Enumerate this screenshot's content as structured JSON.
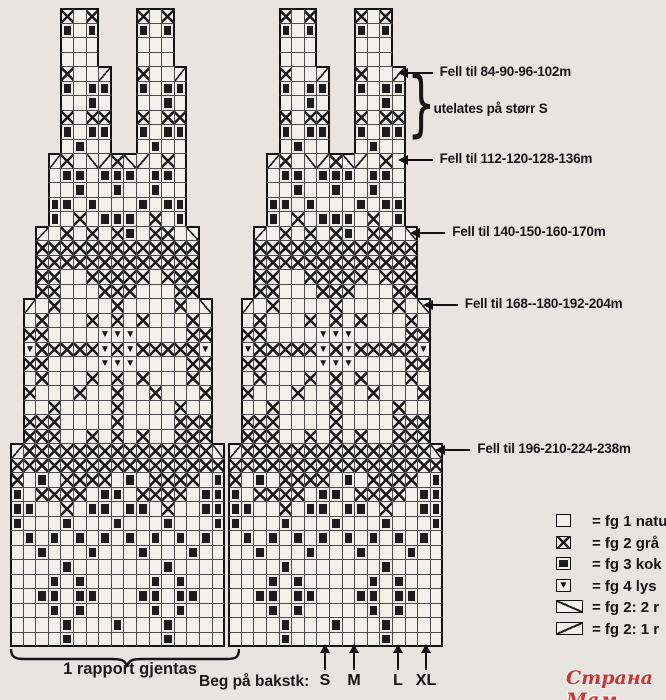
{
  "page": {
    "width": 666,
    "height": 700,
    "background": "#e8e5e0",
    "paper_cell_color": "#f2f0eb",
    "ink_color": "#1a1a1a"
  },
  "chart_data": {
    "type": "heatmap",
    "subtype": "knitting-colorwork-chart",
    "title": "Stranded colorwork chart, two rapports shown side by side with stepped decreases",
    "grid": {
      "panels": 2,
      "cols_per_panel": 17,
      "rows": [
        "    x.x   x.x    ",
        "    f.f   f.f    ",
        "    ...   ...    ",
        "    ...   ...    ",
        "    x..\\  x..\\   ",
        "    f.ff  f.ff   ",
        "    ..f.  ..f.   ",
        "    x.xx  x.xx   ",
        "    f.ff  f.ff   ",
        "    .f..  .f..   ",
        "   \\x./\\x/\\.x.   ",
        "   .ff.fff.ff.   ",
        "   ..f..f..f..   ",
        "   ff.f...f.ff   ",
        "   f.x.fff.x.f   ",
        "  \\.x.x.xf.xx./  ",
        "  xxxxxxxxxxxxx  ",
        "  xxxxxxxxxxxxx  ",
        "  xx..xxxxx.xxx  ",
        "  xx...xxx...xx  ",
        " \\.x....x....x./ ",
        " .x...x.x.x...x. ",
        " xx....vvv....xx ",
        " vxxxxxvxvxxxxxv ",
        " xx....vvv....xx ",
        " .x...x.x.x...x. ",
        " x...x..x..x...x ",
        " ..x....x....x.. ",
        " xxx....x....xxx ",
        " xxx..x.x.x..xxx ",
        "\\xxxxxxxxxxxxxxx/",
        "xxxxxxxxxxxxxxxxx",
        "x.f.xxxx.f.xxxx.f",
        "f.xxxx.ff.xxxx.ff",
        "ff..x.ff.ff.x..ff",
        "f...f...f...f...f",
        ".f.f.f.f.f.f.f.f.",
        "..f...f...f...f..",
        "....f.......f....",
        "...f.f.....f.f...",
        "..ff.ff...ff.ff..",
        "...f.f.....f.f...",
        "....f...f...f....",
        "....f.......f...."
      ],
      "symbol_key": {
        ".": "empty square (fg 1)",
        "x": "cross (fg 2)",
        "f": "filled square (fg 3)",
        "v": "filled triangle (fg 4)",
        "/": "diagonal up decrease cell",
        "\\": "diagonal down decrease cell"
      }
    },
    "annotations": [
      {
        "kind": "arrow",
        "row": 4,
        "text": "Fell til 84-90-96-102m"
      },
      {
        "kind": "brace",
        "row_start": 5,
        "row_end": 8,
        "text": "utelates på størr S"
      },
      {
        "kind": "arrow",
        "row": 10,
        "text": "Fell til 112-120-128-136m"
      },
      {
        "kind": "arrow",
        "row": 15,
        "text": "Fell til 140-150-160-170m"
      },
      {
        "kind": "arrow",
        "row": 20,
        "text": "Fell til 168--180-192-204m"
      },
      {
        "kind": "arrow",
        "row": 30,
        "text": "Fell til 196-210-224-238m"
      }
    ],
    "legend": {
      "items": [
        {
          "symbol": "empty",
          "label": "= fg 1 natu"
        },
        {
          "symbol": "cross",
          "label": "= fg 2 grå"
        },
        {
          "symbol": "filled",
          "label": "= fg 3 kok"
        },
        {
          "symbol": "triangle",
          "label": "= fg 4 lys"
        },
        {
          "symbol": "diag-up",
          "label": "= fg 2: 2 r"
        },
        {
          "symbol": "diag-down",
          "label": "= fg 2: 1 r"
        }
      ]
    }
  },
  "footer": {
    "rapport_label": "1 rapport gjentas",
    "beg_label": "Beg på bakstk:",
    "sizes": [
      "S",
      "M",
      "L",
      "XL"
    ]
  },
  "watermark": {
    "text": "Страна Мам",
    "color": "#cc3636"
  }
}
